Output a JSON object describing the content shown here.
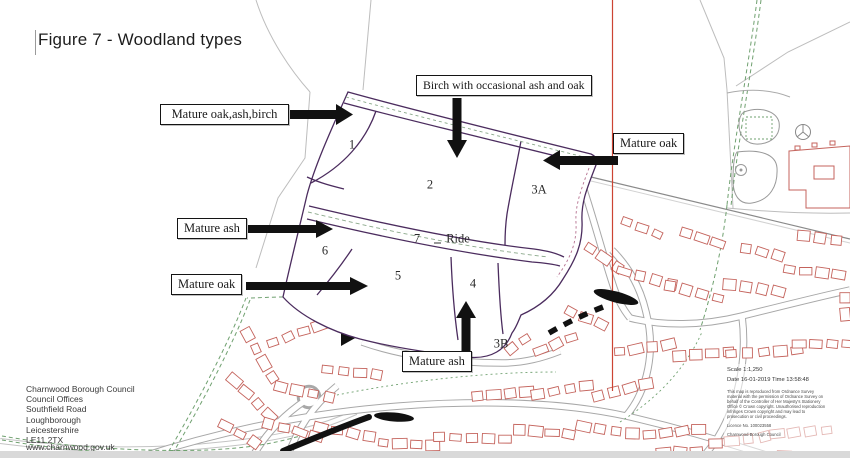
{
  "title": "Figure 7 - Woodland types",
  "callouts": [
    {
      "label": "Mature oak,ash,birch",
      "arrow": "right"
    },
    {
      "label": "Birch with occasional ash and oak",
      "arrow": "down"
    },
    {
      "label": "Mature oak",
      "arrow": "left"
    },
    {
      "label": "Mature ash",
      "arrow": "right"
    },
    {
      "label": "Mature oak",
      "arrow": "right"
    },
    {
      "label": "Mature ash",
      "arrow": "up"
    }
  ],
  "zones": [
    {
      "label": "1"
    },
    {
      "label": "2"
    },
    {
      "label": "3A"
    },
    {
      "label": "6"
    },
    {
      "label": "7"
    },
    {
      "label": "Ride"
    },
    {
      "label": "5"
    },
    {
      "label": "4"
    },
    {
      "label": "3B"
    }
  ],
  "address": {
    "lines": [
      "Charnwood Borough Council",
      "Council Offices",
      "Southfield Road",
      "Loughborough",
      "Leicestershire",
      "LE11 2TX"
    ],
    "website": "www.charnwood.gov.uk"
  },
  "map_info": {
    "scale": "Scale 1:1,250",
    "date_time": "Date 16-01-2019 Time 13:58:48",
    "fine_print": [
      "This map is reproduced from Ordnance Survey",
      "material with the permission of Ordnance Survey on",
      "behalf of the Controller of Her Majesty's Stationery",
      "Office © Crown copyright. Unauthorised reproduction",
      "infringes Crown copyright and may lead to",
      "prosecution or civil proceedings.",
      "Licence No. 100023558",
      "Charnwood Borough Council"
    ]
  },
  "colors": {
    "woodland_boundary": "#4b2c5e",
    "building_outline": "#c4635c",
    "site_line": "#cc4433",
    "footpath_green": "#6fa06f",
    "road_gray": "#a8a8a8",
    "annotation_black": "#111111"
  }
}
